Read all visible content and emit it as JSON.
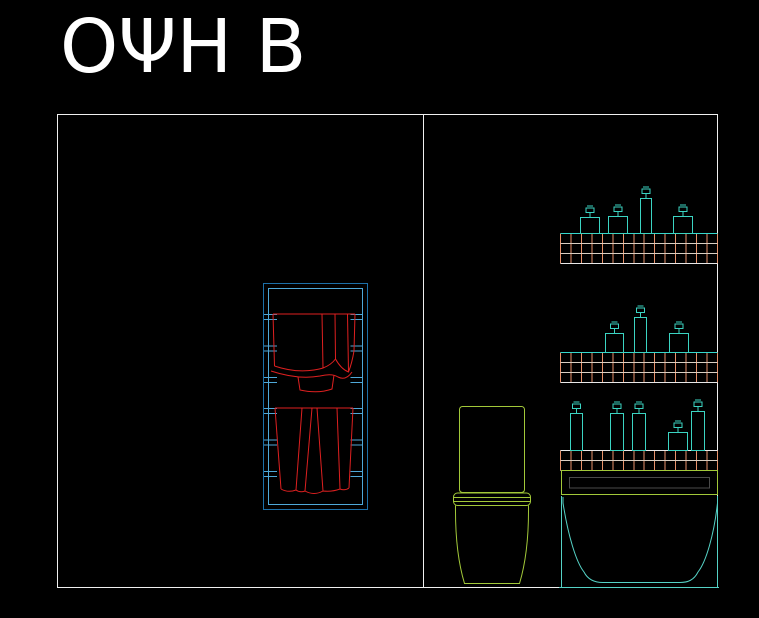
{
  "canvas": {
    "width": 759,
    "height": 618,
    "background": "#000000"
  },
  "title": "ΟΨΗ Β",
  "colors": {
    "bg": "#000000",
    "title": "#FFFFFF",
    "outline": "#F0F0F0",
    "rack_outer": "#1C6FA8",
    "rack_inner": "#4FA8D8",
    "towel": "#DE2020",
    "toilet": "#A2C839",
    "apron": "#A2C839",
    "apron_inner": "#4A4A4A",
    "turquoise": "#3BD4C2",
    "tub": "#55D2C6",
    "tile_vertical": "#E8926B",
    "tile_horizontal": "#D9CFC3",
    "shelf_top": "#35D8CC",
    "shelf_edge_white": "#E8E8E8"
  },
  "drawing": {
    "view_label": "ΟΨΗ Β",
    "room": {
      "x": 57.5,
      "y": 114.5,
      "width": 660,
      "height": 473,
      "divider_x": 423.5
    },
    "towel_rack": {
      "outer": [
        263.5,
        283.5,
        104,
        226
      ],
      "inner": [
        268.5,
        288.5,
        94,
        216
      ],
      "rung_left": [
        264,
        277
      ],
      "rung_right": [
        350.5,
        363
      ],
      "rung_line_ys": [
        314.5,
        319.5,
        346,
        351,
        377.5,
        382.5,
        408.5,
        413.5,
        440,
        445,
        471.5,
        476.5
      ]
    },
    "shelves": [
      {
        "x": 560.5,
        "y": 233.5,
        "width": 157,
        "height": 30,
        "rows": 3,
        "cols": 15,
        "top": "shelf_top",
        "bottom": "shelf_edge_white"
      },
      {
        "x": 560.5,
        "y": 352.5,
        "width": 157,
        "height": 30,
        "rows": 3,
        "cols": 15,
        "top": "shelf_top",
        "bottom": "shelf_edge_white"
      },
      {
        "x": 560.5,
        "y": 450.5,
        "width": 157,
        "height": 20,
        "rows": 2,
        "cols": 15,
        "top": "shelf_edge_white",
        "bottom": "tile_horizontal"
      }
    ],
    "bottles": [
      {
        "x": 580,
        "y": 217,
        "w": 19,
        "h": 16
      },
      {
        "x": 608,
        "y": 216,
        "w": 19,
        "h": 17
      },
      {
        "x": 640,
        "y": 198,
        "w": 11,
        "h": 35
      },
      {
        "x": 673,
        "y": 216,
        "w": 19,
        "h": 17
      },
      {
        "x": 605,
        "y": 333,
        "w": 18,
        "h": 19
      },
      {
        "x": 634,
        "y": 317,
        "w": 12,
        "h": 35
      },
      {
        "x": 669,
        "y": 333,
        "w": 19,
        "h": 19
      },
      {
        "x": 570,
        "y": 413,
        "w": 12,
        "h": 37
      },
      {
        "x": 610,
        "y": 413,
        "w": 13,
        "h": 37
      },
      {
        "x": 632,
        "y": 413,
        "w": 13,
        "h": 37
      },
      {
        "x": 668,
        "y": 432,
        "w": 19,
        "h": 18
      },
      {
        "x": 691,
        "y": 411,
        "w": 13,
        "h": 39
      }
    ],
    "pump": {
      "stem_h": 5,
      "cap_w": 8,
      "cap_h": 4.5,
      "cap_off": 9.5,
      "nub_w": 6,
      "nub_off": 11.5
    }
  }
}
